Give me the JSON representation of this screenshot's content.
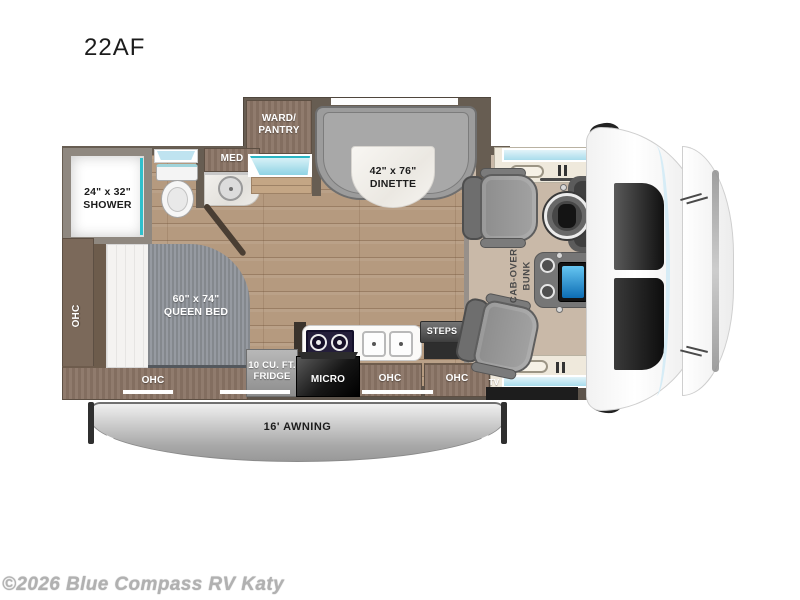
{
  "title": "22AF",
  "watermark": "©2026 Blue Compass RV Katy",
  "labels": {
    "shower": "24\" x 32\"\nSHOWER",
    "med": "MED",
    "ward_pantry": "WARD/\nPANTRY",
    "dinette": "42\" x 76\"\nDINETTE",
    "queen_bed": "60\" x 74\"\nQUEEN BED",
    "ohc_left": "OHC",
    "ohc_bottom": "OHC",
    "ohc_mid": "OHC",
    "ohc_right": "OHC",
    "fridge": "10 CU. FT.\nFRIDGE",
    "micro": "MICRO",
    "steps": "STEPS",
    "tv": "TV",
    "cab_over_bunk": "CAB-OVER\nBUNK",
    "awning": "16' AWNING"
  },
  "colors": {
    "teal_accent": "#2ab6c4",
    "window_blue": "#cde9f5",
    "wood_floor": "#b59a7f",
    "wall": "#675d52",
    "cabinet_brown": "#8a7465",
    "bench_gray": "#9c9c9c",
    "screen_blue": "#2e9df0",
    "awning_gray": "#b5b5b5",
    "watermark_gray": "#b1b1b1"
  }
}
